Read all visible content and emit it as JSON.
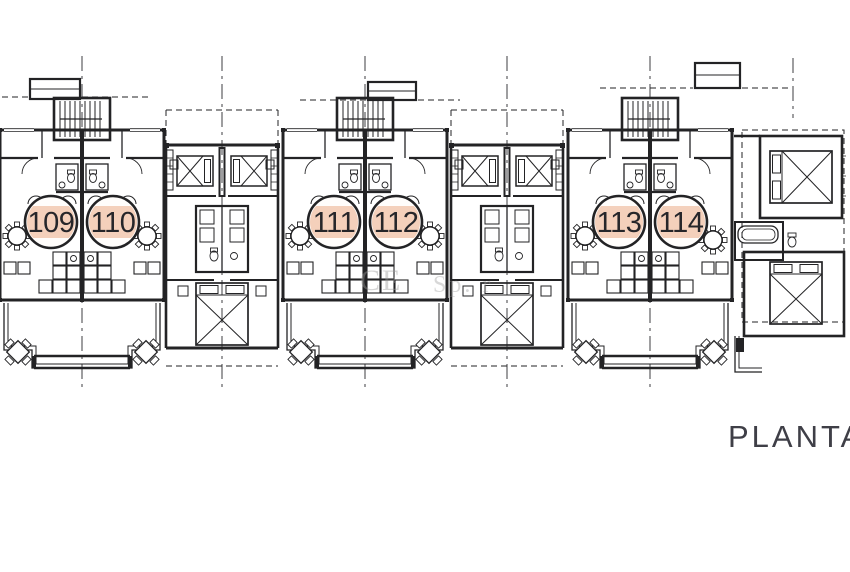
{
  "plan": {
    "title_label": "PLANTA",
    "units": [
      {
        "number": "109"
      },
      {
        "number": "110"
      },
      {
        "number": "111"
      },
      {
        "number": "112"
      },
      {
        "number": "113"
      },
      {
        "number": "114"
      }
    ],
    "watermark": {
      "left": "CE",
      "right": "Sp. r"
    },
    "colors": {
      "line": "#232325",
      "highlight": "#f3cbb4",
      "watermark": "#9a9a9a",
      "title": "#3f3f47"
    }
  }
}
